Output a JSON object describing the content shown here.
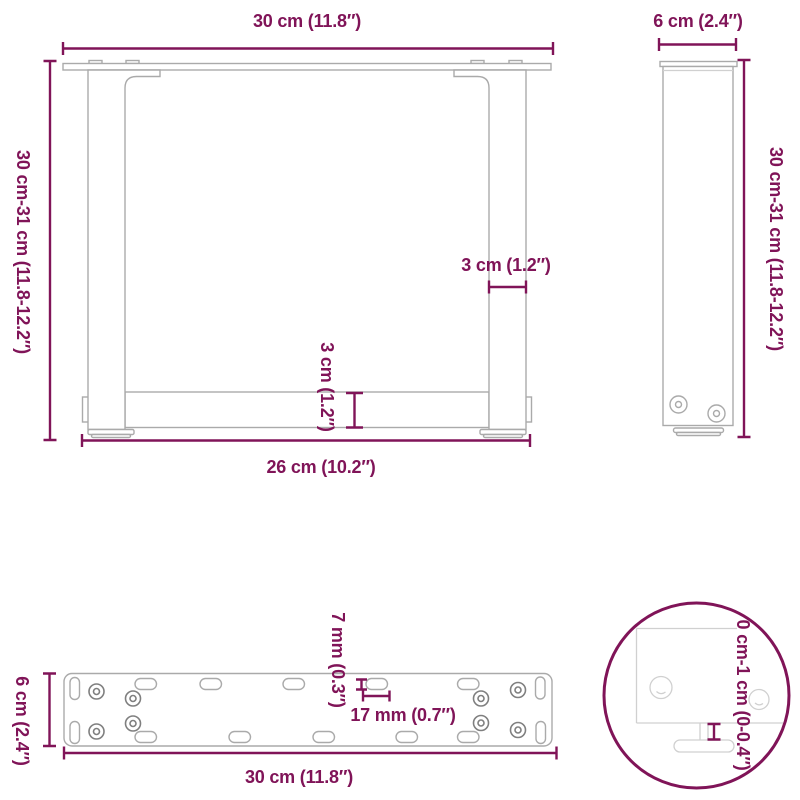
{
  "title": "Table legs dimension diagram",
  "colors": {
    "dimension": "#801458",
    "outline": "#aaaaaa",
    "outline_light": "#d0d0d0",
    "outline_dark": "#7f7f7f",
    "background": "#ffffff"
  },
  "drawings": {
    "front_view": {
      "dims": {
        "top_width": "30 cm (11.8″)",
        "height": "30 cm-31 cm (11.8-12.2″)",
        "leg_width": "3 cm (1.2″)",
        "crossbar_height": "3 cm (1.2″)",
        "inner_width": "26 cm (10.2″)"
      }
    },
    "side_view": {
      "dims": {
        "depth": "6 cm (2.4″)",
        "height": "30 cm-31 cm (11.8-12.2″)"
      }
    },
    "plate_top_view": {
      "dims": {
        "depth": "6 cm (2.4″)",
        "slot_height": "7 mm (0.3″)",
        "slot_length": "17 mm (0.7″)",
        "width": "30 cm (11.8″)"
      }
    },
    "foot_detail": {
      "dims": {
        "adjustable_height": "0 cm-1 cm (0-0.4″)"
      }
    }
  }
}
